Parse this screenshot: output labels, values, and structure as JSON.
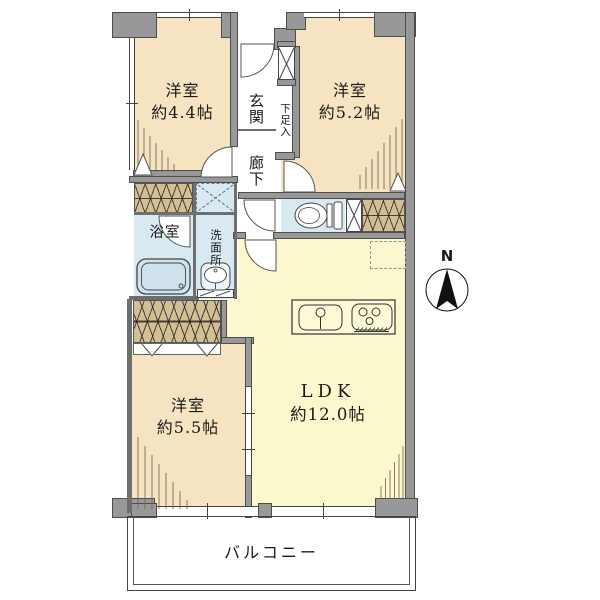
{
  "colors": {
    "room": "#f6e3c2",
    "ldk": "#fcf8cd",
    "wet": "#d9e9f1",
    "closet": "#d3bf96",
    "wall": "#989898",
    "text": "#1a1a1a"
  },
  "rooms": {
    "bedroom1": {
      "name": "洋室",
      "size": "約4.4帖"
    },
    "bedroom2": {
      "name": "洋室",
      "size": "約5.2帖"
    },
    "bedroom3": {
      "name": "洋室",
      "size": "約5.5帖"
    },
    "ldk": {
      "name": "LDK",
      "size": "約12.0帖"
    },
    "entrance": {
      "name": "玄関"
    },
    "hallway": {
      "name": "廊下"
    },
    "shoe_box": {
      "name": "下足入"
    },
    "bathroom": {
      "name": "浴室"
    },
    "washroom": {
      "name": "洗面所"
    },
    "balcony": {
      "name": "バルコニー"
    }
  },
  "compass": {
    "label": "N"
  }
}
